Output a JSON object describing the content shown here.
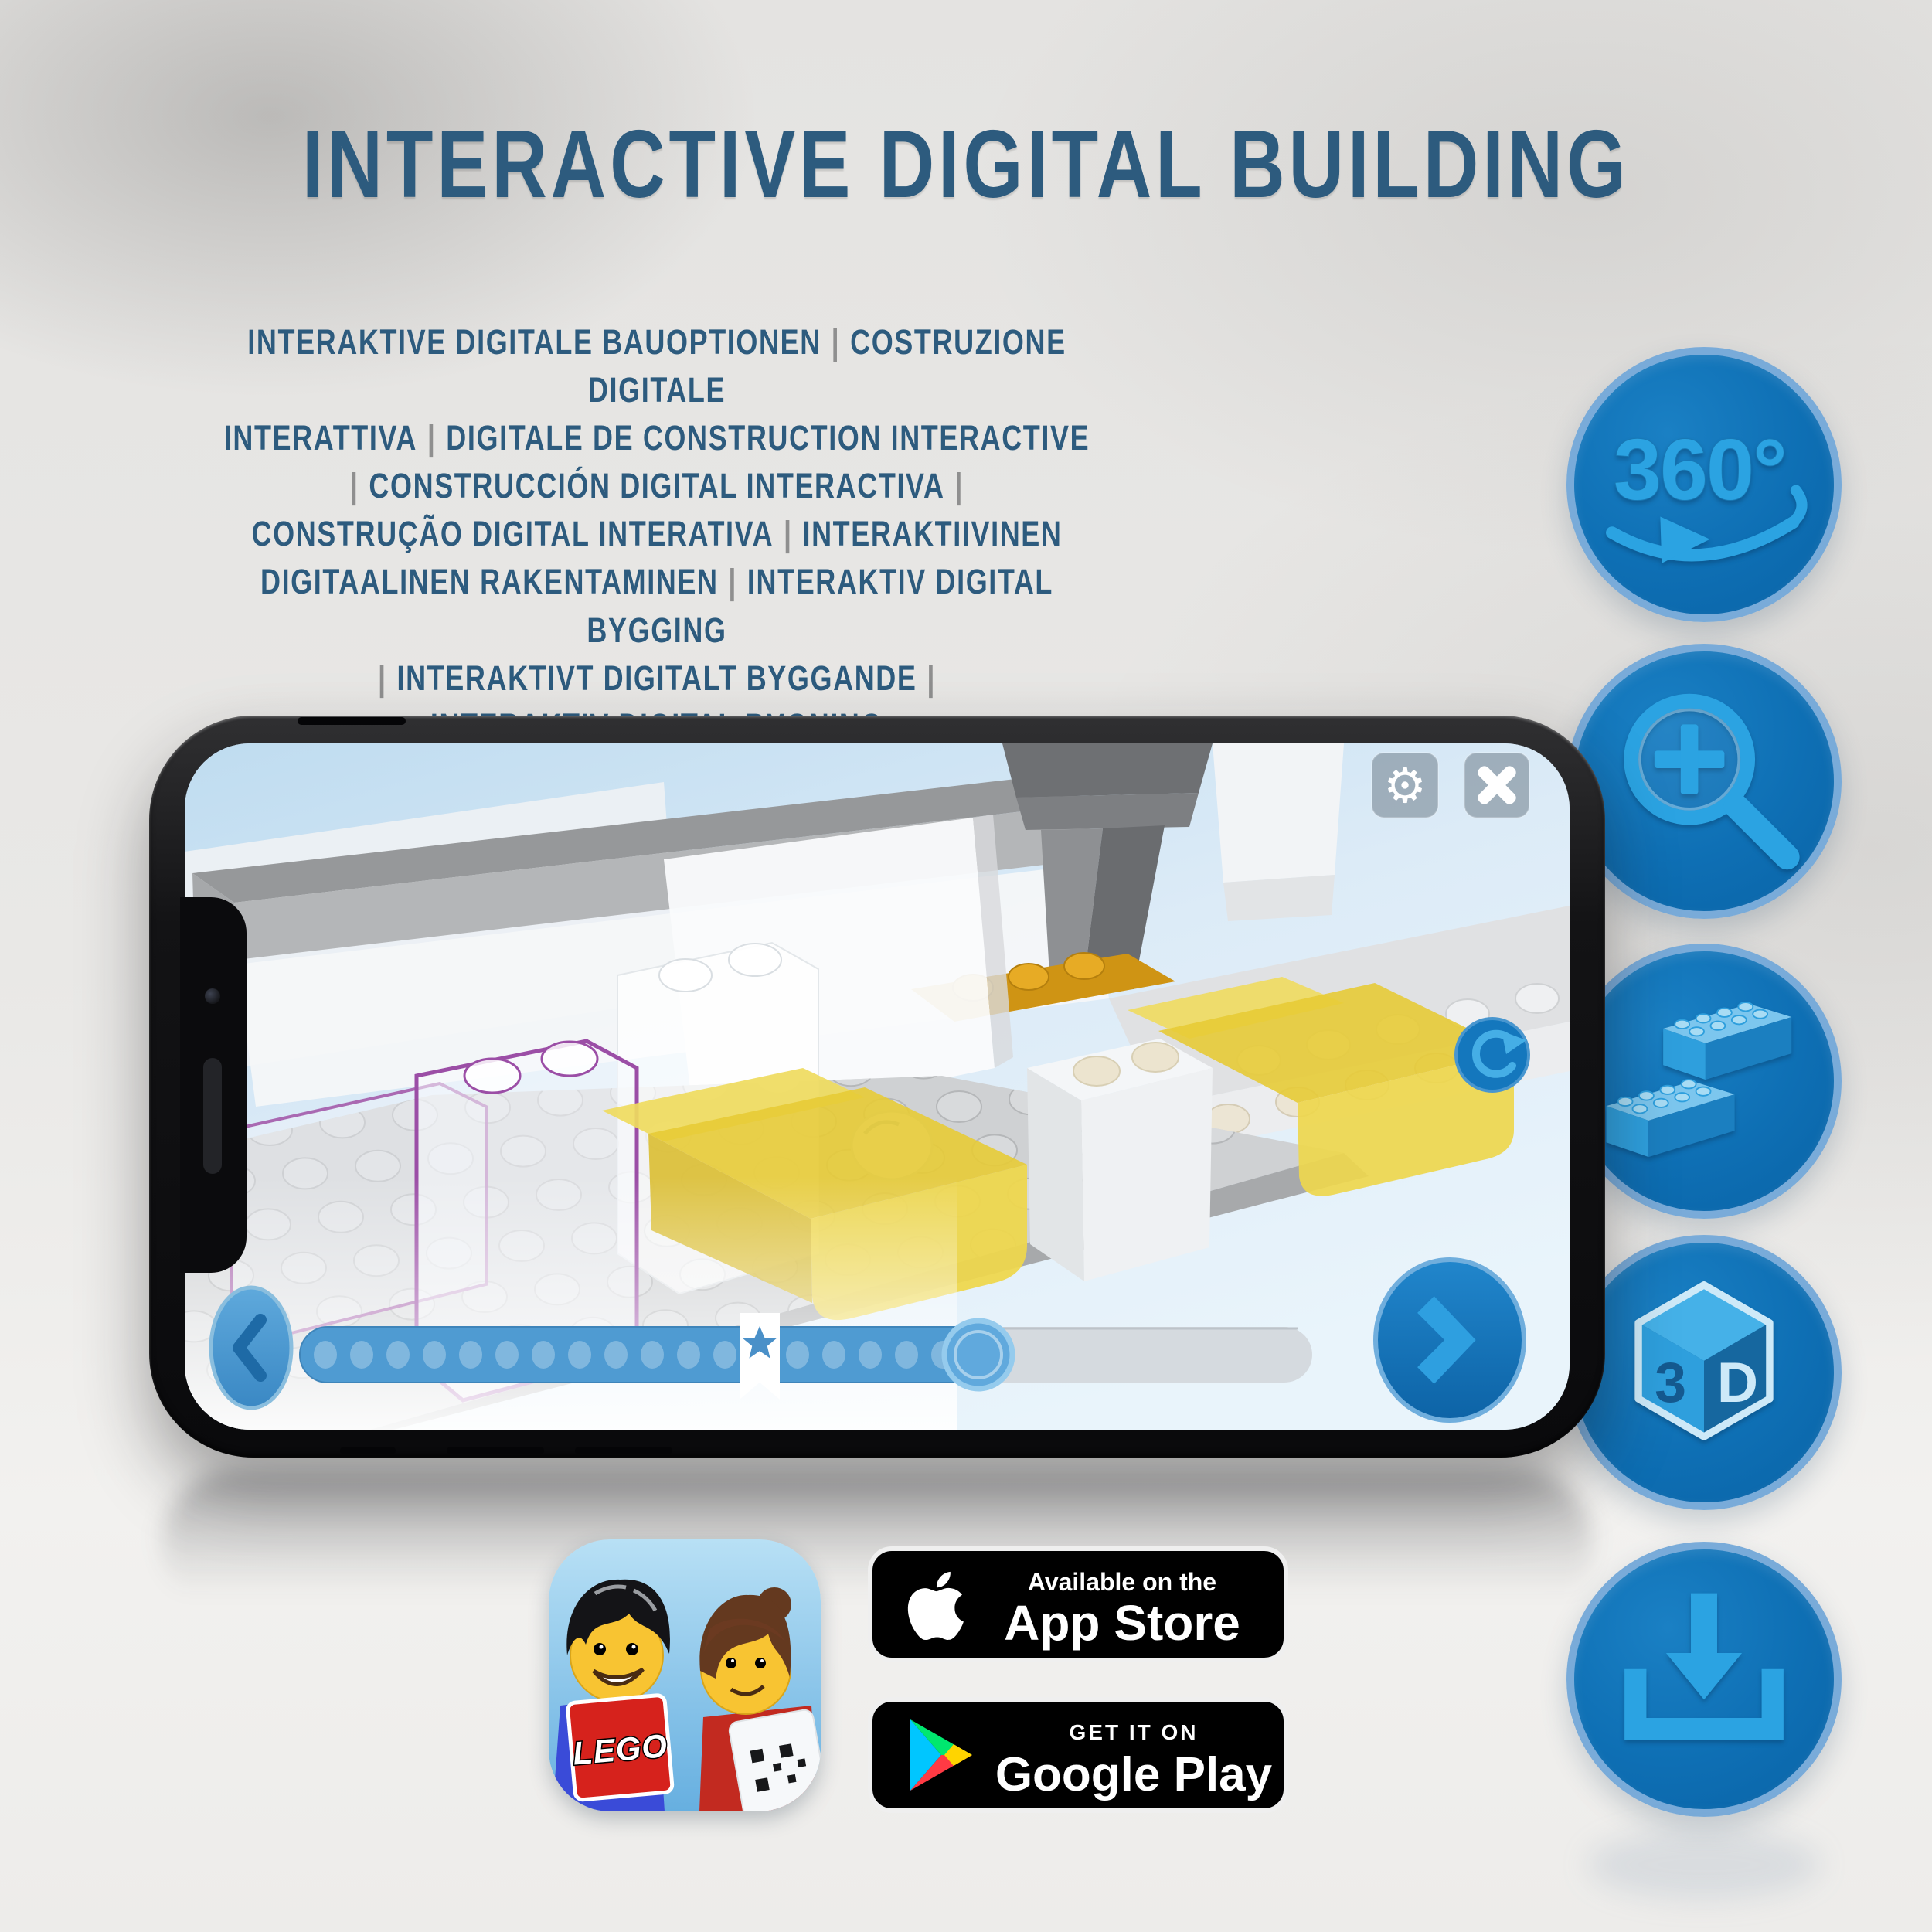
{
  "title": "INTERACTIVE DIGITAL BUILDING",
  "subtitle_lines": [
    "INTERAKTIVE DIGITALE BAUOPTIONEN | COSTRUZIONE DIGITALE",
    "INTERATTIVA | DIGITALE DE CONSTRUCTION INTERACTIVE",
    "| CONSTRUCCIÓN DIGITAL INTERACTIVA |",
    "CONSTRUÇÃO DIGITAL INTERATIVA | INTERAKTIIVINEN",
    "DIGITAALINEN RAKENTAMINEN | INTERAKTIV DIGITAL BYGGING",
    "| INTERAKTIVT DIGITALT BYGGANDE |",
    "INTERAKTIV DIGITAL BYGNING"
  ],
  "features": [
    {
      "name": "360-rotation",
      "label": "360°"
    },
    {
      "name": "zoom-in"
    },
    {
      "name": "brick-building"
    },
    {
      "name": "3d-view",
      "left_face": "3",
      "right_face": "D"
    },
    {
      "name": "download"
    }
  ],
  "phone_ui": {
    "settings_glyph": "⚙"
  },
  "badges": {
    "app_store": {
      "line1": "Available on the",
      "line2": "App Store"
    },
    "google_play": {
      "line1": "GET IT ON",
      "line2": "Google Play"
    }
  },
  "app_icon": {
    "logo_text": "LEGO"
  },
  "colors": {
    "title_blue": "#2d5b7e",
    "separator_grey": "#8f8f8f",
    "circle_fill": "#0e6fb4",
    "circle_ring": "#79abd9",
    "glyph_blue": "#2ba3e2",
    "progress_fill": "#4f9bd2",
    "screen_sky": "#cfe4f4",
    "bed_yellow": "#e7cb36",
    "outline_purple": "#9b4ea6"
  }
}
